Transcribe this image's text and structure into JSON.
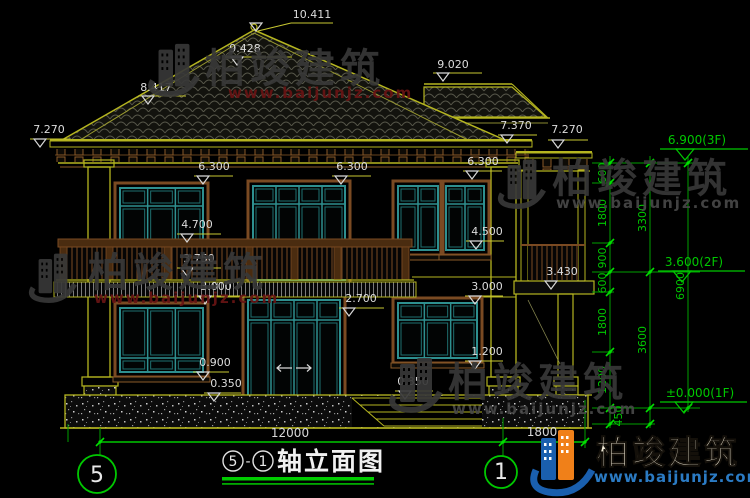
{
  "drawing": {
    "levels": {
      "peak": "10.411",
      "left_slope": "9.428",
      "left_wing": "8.417",
      "right_wing_ridge": "9.020",
      "eave_left": "7.270",
      "eave_right_main": "7.370",
      "eave_right_porch": "7.270",
      "window_head_2f_left": "6.300",
      "window_head_2f_center": "6.300",
      "window_head_2f_right": "6.300",
      "balcony_rail_top": "4.700",
      "balcony_rail_base": "3.750",
      "slab_bottom_left": "3.000",
      "window_sill_2f_right": "4.500",
      "slab_bottom_right": "3.000",
      "porch_roof_slab": "3.430",
      "door_head": "2.700",
      "window_sill_1f_left": "0.900",
      "plinth_top_left": "0.350",
      "window_sill_1f_right": "1.200",
      "plinth_top_right": "0.350"
    },
    "floor_marks": {
      "third": "6.900(3F)",
      "second": "3.600(2F)",
      "first": "±0.000(1F)"
    },
    "dim_chains": {
      "inner": [
        "600",
        "1800",
        "900",
        "600",
        "1800",
        "1200"
      ],
      "foot": "450",
      "middle": [
        "3300",
        "3600"
      ],
      "overall": "6900",
      "bottom_main": "12000",
      "bottom_porch": "1800"
    },
    "axes": {
      "left": "5",
      "right": "1"
    }
  },
  "title_bar": {
    "axis_a": "5",
    "separator": "-",
    "axis_b": "1",
    "name": "轴立面图"
  },
  "watermark": {
    "brand": "柏竣建筑",
    "url": "www.baijunjz.com"
  },
  "colors": {
    "dim_green": "#00c800",
    "cad_yellow": "#b5b520",
    "window_teal": "#2e8f8f",
    "trim_brown": "#7a4a22",
    "text_white": "#dcdcdc",
    "logo_blue": "#1a5fae",
    "logo_orange": "#f08019"
  }
}
